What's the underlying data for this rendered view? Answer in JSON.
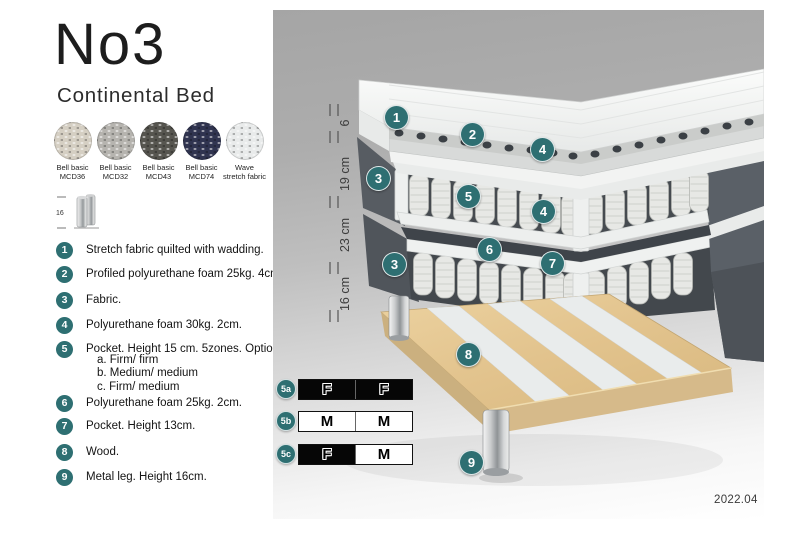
{
  "header": {
    "model": "No3",
    "subtitle": "Continental Bed"
  },
  "swatches": {
    "items": [
      {
        "line1": "Bell basic",
        "line2": "MCD36",
        "color": "#d5cfc3"
      },
      {
        "line1": "Bell basic",
        "line2": "MCD32",
        "color": "#b6b4af"
      },
      {
        "line1": "Bell basic",
        "line2": "MCD43",
        "color": "#56554f"
      },
      {
        "line1": "Bell basic",
        "line2": "MCD74",
        "color": "#303450"
      },
      {
        "line1": "Wave",
        "line2": "stretch fabric",
        "color": "#e9ebeb"
      }
    ]
  },
  "leg_icon": {
    "dimension": "16"
  },
  "legend": {
    "items": [
      {
        "num": "1",
        "text": "Stretch fabric quilted with wadding."
      },
      {
        "num": "2",
        "text": "Profiled polyurethane foam 25kg. 4cm."
      },
      {
        "num": "3",
        "text": "Fabric."
      },
      {
        "num": "4",
        "text": "Polyurethane foam 30kg. 2cm."
      },
      {
        "num": "5",
        "text": "Pocket. Height 15 cm. 5zones. Option:"
      },
      {
        "num": "6",
        "text": "Polyurethane foam 25kg. 2cm."
      },
      {
        "num": "7",
        "text": "Pocket. Height 13cm."
      },
      {
        "num": "8",
        "text": "Wood."
      },
      {
        "num": "9",
        "text": "Metal leg. Height 16cm."
      }
    ],
    "item5_options": [
      "a. Firm/ firm",
      "b. Medium/ medium",
      "c. Firm/ medium"
    ]
  },
  "diagram": {
    "accent_color": "#2e6f72",
    "dimension_labels": [
      "6",
      "19 cm",
      "23 cm",
      "16 cm"
    ],
    "callout_markers": [
      {
        "n": "1"
      },
      {
        "n": "2"
      },
      {
        "n": "4"
      },
      {
        "n": "3"
      },
      {
        "n": "5"
      },
      {
        "n": "4"
      },
      {
        "n": "6"
      },
      {
        "n": "3"
      },
      {
        "n": "7"
      },
      {
        "n": "8"
      },
      {
        "n": "9"
      }
    ],
    "firmness_tables": [
      {
        "label": "5a",
        "cells": [
          {
            "text": "F",
            "filled": true
          },
          {
            "text": "F",
            "filled": true
          }
        ]
      },
      {
        "label": "5b",
        "cells": [
          {
            "text": "M",
            "filled": false
          },
          {
            "text": "M",
            "filled": false
          }
        ]
      },
      {
        "label": "5c",
        "cells": [
          {
            "text": "F",
            "filled": true
          },
          {
            "text": "M",
            "filled": false
          }
        ]
      }
    ],
    "version": "2022.04"
  }
}
